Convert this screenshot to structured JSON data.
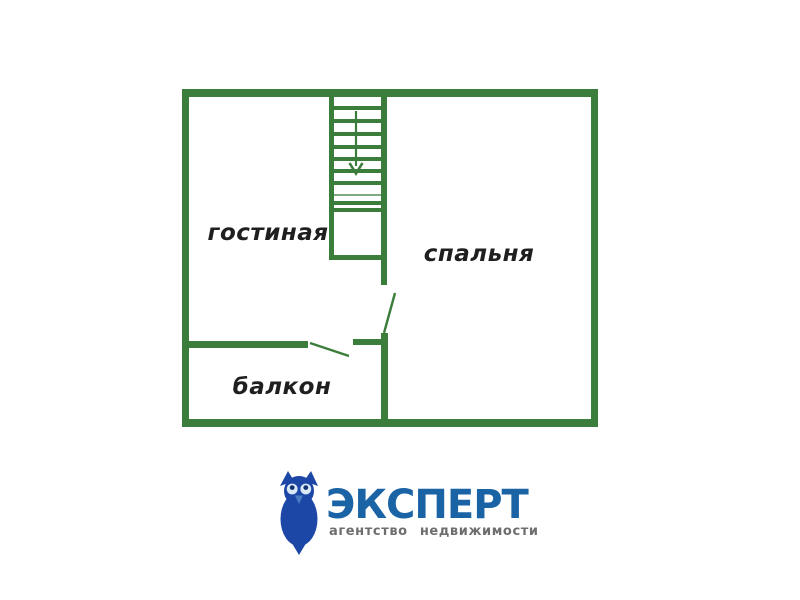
{
  "colors": {
    "wall-green": "#3b7d3b",
    "label-text": "#1f1f1f",
    "brand-blue": "#1a63a5",
    "owl-blue": "#1d47a6",
    "owl-eye": "#d9e9f8",
    "owl-pupil": "#12336e",
    "owl-beak": "#4a7cc2",
    "tagline-gray": "#6e6e6e",
    "background": "#ffffff"
  },
  "floor_plan": {
    "rooms": [
      {
        "name": "living-room",
        "label": "гостиная"
      },
      {
        "name": "bedroom",
        "label": "спальня"
      },
      {
        "name": "balcony",
        "label": "балкон"
      }
    ],
    "staircase": {
      "direction": "down",
      "steps_visible": 10
    },
    "doors": [
      "bedroom-doorway",
      "balcony-doorway"
    ]
  },
  "logo": {
    "brand": "ЭКСПЕРТ",
    "tagline": "агентство  недвижимости",
    "icon": "owl-icon"
  }
}
